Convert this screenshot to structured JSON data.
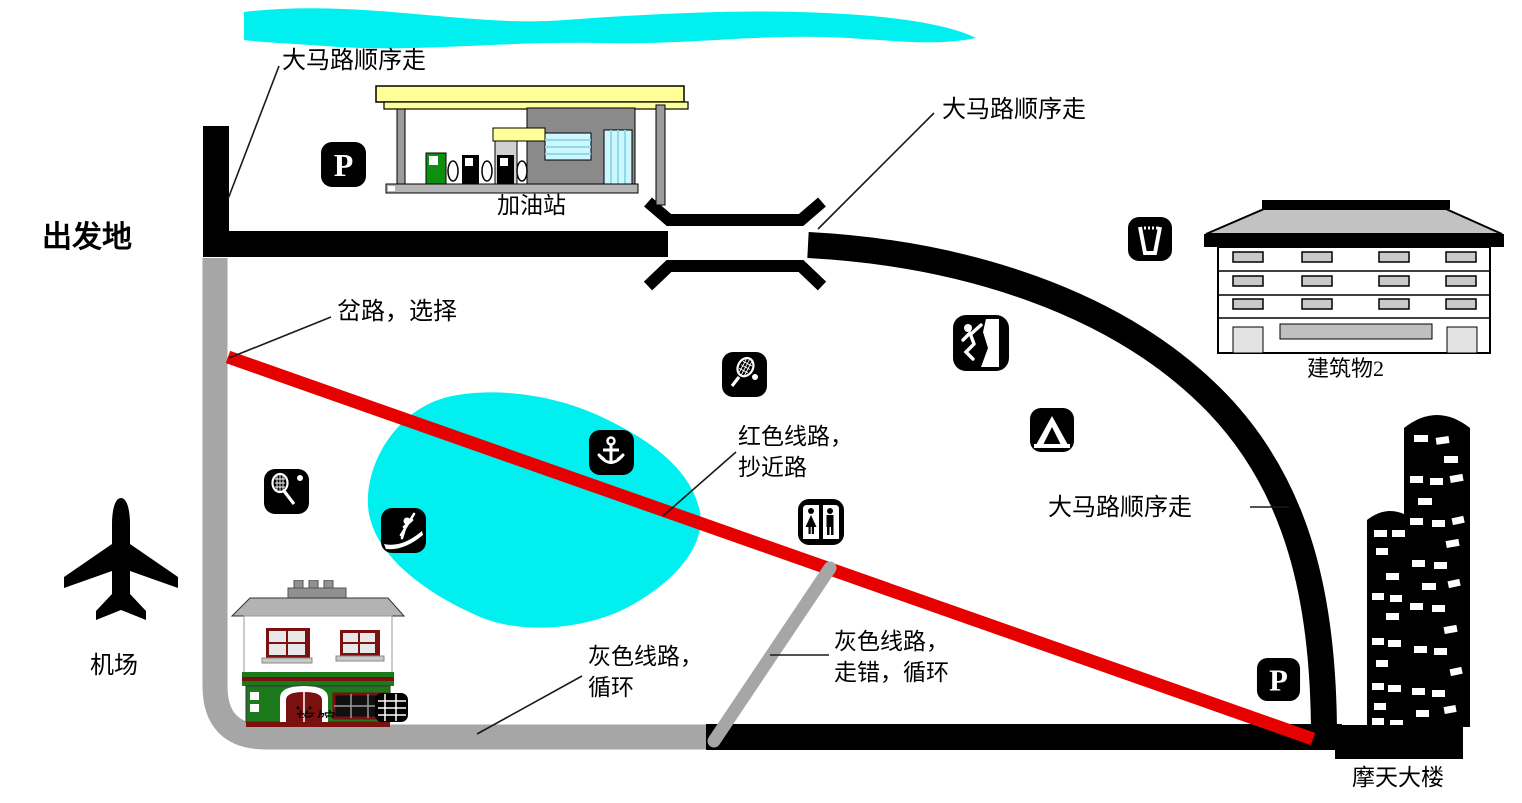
{
  "map": {
    "labels": {
      "start": "出发地",
      "follow_main_road_top_left": "大马路顺序走",
      "follow_main_road_top_right": "大马路顺序走",
      "follow_main_road_right": "大马路顺序走",
      "fork_choose": "岔路，选择",
      "red_route_line1": "红色线路，",
      "red_route_line2": "抄近路",
      "gray_loop_line1": "灰色线路，",
      "gray_loop_line2": "循环",
      "gray_wrong_line1": "灰色线路，",
      "gray_wrong_line2": "走错，循环",
      "gas_station": "加油站",
      "building2": "建筑物2",
      "skyscraper": "摩天大楼",
      "airport": "机场",
      "inn_hidden": "旅馆"
    },
    "icon_labels": {
      "parking_top": "P",
      "parking_bottom": "P"
    },
    "icon_names": [
      "parking-icon",
      "cup-icon",
      "tennis-racket-ball-icon",
      "climbing-icon",
      "camping-icon",
      "anchor-icon",
      "kayak-icon",
      "restroom-icon",
      "airplane-icon"
    ],
    "colors": {
      "road_black": "#000000",
      "gray_route": "#a6a6a6",
      "red_route": "#e60000",
      "water_cyan": "#00efef",
      "canopy_yellow": "#ffff99"
    }
  }
}
